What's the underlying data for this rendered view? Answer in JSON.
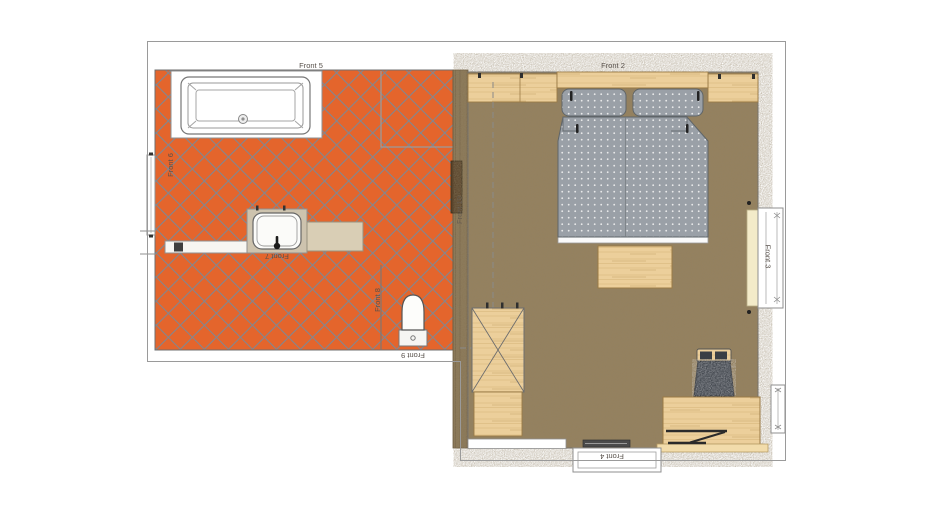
{
  "plan": {
    "view": "2d-floor-plan",
    "labels": {
      "front_1": "Front 1",
      "front_2": "Front 2",
      "front_3": "Front 3",
      "front_4": "Front 4",
      "front_5": "Front 5",
      "front_6": "Front 6",
      "front_7": "Front 7",
      "front_8": "Front 8",
      "front_9": "Front 9",
      "front_10": "Front 10"
    },
    "rooms": [
      {
        "id": "bathroom",
        "floor_style": "terracotta-diagonal-tiles"
      },
      {
        "id": "bedroom",
        "floor_style": "brown-carpet"
      }
    ],
    "furniture": {
      "bathroom": [
        "bathtub",
        "shower-partition",
        "vanity-washbasin",
        "countertop",
        "wall-shelf",
        "toilet",
        "left-window"
      ],
      "bedroom": [
        "headboard",
        "bedside-cabinet-left",
        "bedside-cabinet-right",
        "double-bed",
        "pillows",
        "foot-bench",
        "wardrobe",
        "dresser",
        "desk",
        "laptop",
        "chair",
        "right-window",
        "small-right-window",
        "bottom-window",
        "radiator"
      ]
    },
    "colors": {
      "tile": "#e4652c",
      "grout": "#7e8894",
      "carpet": "#95815e",
      "wood": "#eccf9b",
      "wood_grain": "#d8b67c",
      "wood_dark": "#8a7756",
      "wood_dark_grain": "#6f5e44",
      "fabric": "#9aa0a7",
      "fabric_dot": "#f2f2f2",
      "seat": "#3f444b",
      "sill": "#f3ebc9",
      "wall_line": "#8f8f8f",
      "label": "#57504a",
      "dark": "#2f2f2f"
    }
  }
}
